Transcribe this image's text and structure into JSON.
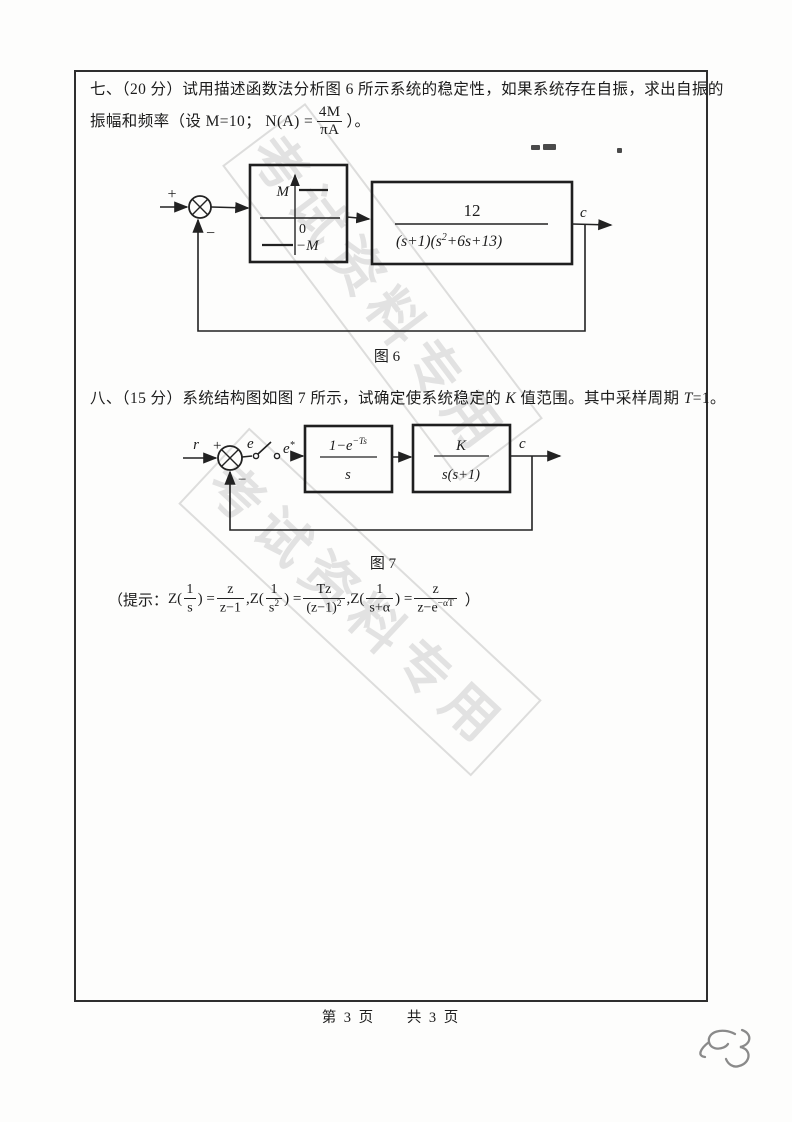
{
  "page": {
    "footer_page": "第 3 页",
    "footer_total": "共 3 页",
    "handwritten_mark": "53",
    "watermark_text": "考试资料专用"
  },
  "q7": {
    "line1": "七、（20 分）试用描述函数法分析图 6 所示系统的稳定性，如果系统存在自振，求出自振的",
    "line2_pre": "振幅和频率（设 M=10；  N(A) =",
    "frac_num": "4M",
    "frac_den": "πA",
    "line2_post": "）。",
    "fig6": {
      "plus": "+",
      "minus": "−",
      "relay_top": "M",
      "relay_zero": "0",
      "relay_bottom": "−M",
      "tf_num": "12",
      "tf_den_pre": "(s+1)(s",
      "tf_den_sup": "2",
      "tf_den_post": "+6s+13)",
      "output": "c",
      "caption": "图 6"
    }
  },
  "q8": {
    "line1_a": "八、（15 分）系统结构图如图 7 所示，试确定使系统稳定的 ",
    "line1_k": "K",
    "line1_b": " 值范围。其中采样周期 ",
    "line1_t": "T",
    "line1_c": "=1。",
    "fig7": {
      "r": "r",
      "plus": "+",
      "e": "e",
      "estar_base": "e",
      "estar_sup": "*",
      "minus": "−",
      "b1_num_base": "1−e",
      "b1_num_sup": "−Ts",
      "b1_den": "s",
      "b2_num": "K",
      "b2_den": "s(s+1)",
      "output": "c",
      "caption": "图 7"
    },
    "hint": {
      "open": "（提示：",
      "terms": [
        {
          "pre": "Z(",
          "anum": "1",
          "aden": "s",
          "adensup": "",
          "post": ") =",
          "rnum": "z",
          "rden": "z−1",
          "rdensup": "",
          "sep": ","
        },
        {
          "pre": "Z(",
          "anum": "1",
          "aden": "s",
          "adensup": "2",
          "post": ") =",
          "rnum": "Tz",
          "rden": "(z−1)",
          "rdensup": "2",
          "sep": ","
        },
        {
          "pre": "Z(",
          "anum": "1",
          "aden": "s+α",
          "adensup": "",
          "post": ") =",
          "rnum": "z",
          "rden": "z−e",
          "rdensup": "−αT",
          "sep": ""
        }
      ],
      "close": "）"
    }
  }
}
